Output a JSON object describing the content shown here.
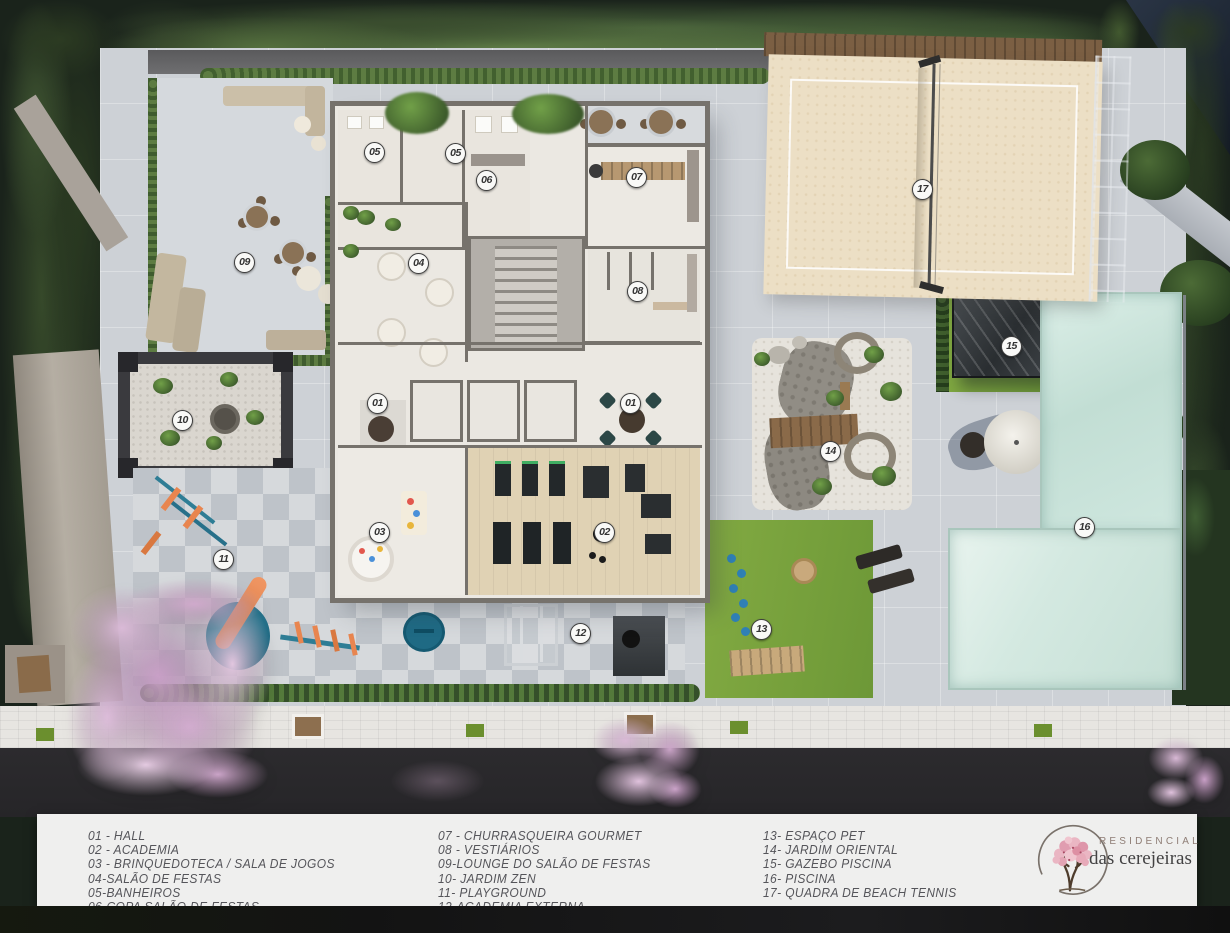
{
  "legend": {
    "columns": [
      {
        "items": [
          "01 - HALL",
          "02 - ACADEMIA",
          "03 - BRINQUEDOTECA / SALA DE JOGOS",
          "04-SALÃO DE FESTAS",
          "05-BANHEIROS",
          "06-COPA SALÃO DE FESTAS"
        ]
      },
      {
        "items": [
          "07 - CHURRASQUEIRA GOURMET",
          "08 - VESTIÁRIOS",
          "09-LOUNGE DO SALÃO DE FESTAS",
          "10- JARDIM ZEN",
          "11- PLAYGROUND",
          "12-ACADEMIA EXTERNA"
        ]
      },
      {
        "items": [
          "13- ESPAÇO PET",
          "14- JARDIM ORIENTAL",
          "15- GAZEBO PISCINA",
          "16- PISCINA",
          "17- QUADRA DE BEACH TENNIS"
        ]
      }
    ]
  },
  "logo": {
    "line1": "RESIDENCIAL",
    "line2": "das cerejeiras"
  },
  "markers": [
    {
      "label": "01",
      "x": 378,
      "y": 404
    },
    {
      "label": "01",
      "x": 631,
      "y": 404
    },
    {
      "label": "02",
      "x": 605,
      "y": 533
    },
    {
      "label": "03",
      "x": 380,
      "y": 533
    },
    {
      "label": "04",
      "x": 419,
      "y": 264
    },
    {
      "label": "05",
      "x": 375,
      "y": 153
    },
    {
      "label": "05",
      "x": 456,
      "y": 154
    },
    {
      "label": "06",
      "x": 487,
      "y": 181
    },
    {
      "label": "07",
      "x": 637,
      "y": 178
    },
    {
      "label": "08",
      "x": 638,
      "y": 292
    },
    {
      "label": "09",
      "x": 245,
      "y": 263
    },
    {
      "label": "10",
      "x": 183,
      "y": 421
    },
    {
      "label": "11",
      "x": 224,
      "y": 560
    },
    {
      "label": "12",
      "x": 581,
      "y": 634
    },
    {
      "label": "13",
      "x": 762,
      "y": 630
    },
    {
      "label": "14",
      "x": 831,
      "y": 452
    },
    {
      "label": "15",
      "x": 1012,
      "y": 347
    },
    {
      "label": "16",
      "x": 1085,
      "y": 528
    },
    {
      "label": "17",
      "x": 923,
      "y": 190
    }
  ],
  "colors": {
    "paving": "#cdd1d6",
    "water": "#cfe6dd",
    "grass": "#7ba43e",
    "sand": "#ecdfc5",
    "accent_orange": "#e8854f",
    "accent_teal": "#2e7d95",
    "cherry_pink": "#d9b9d6",
    "legend_bg": "#efefee",
    "marker_border": "#3e3e3e",
    "logo_pink": "#e09db0"
  }
}
